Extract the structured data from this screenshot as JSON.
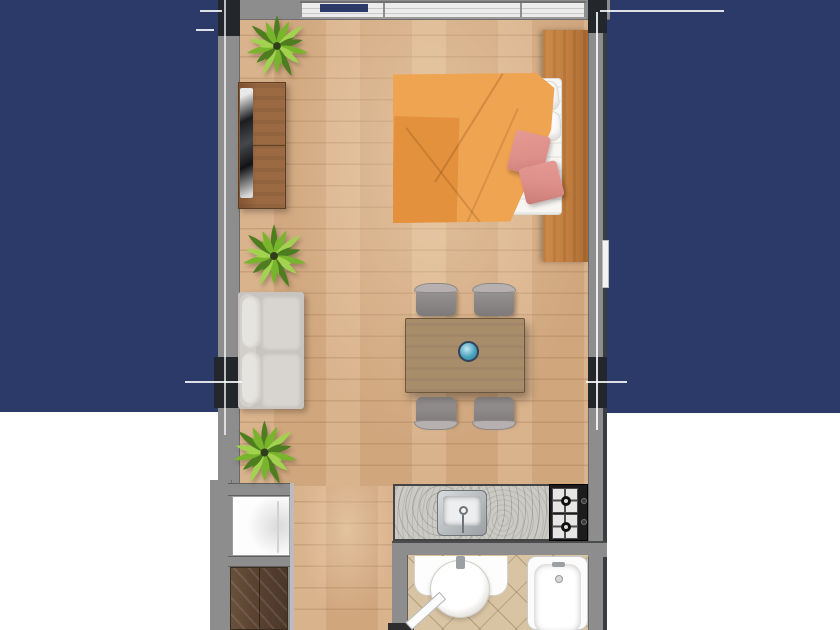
{
  "scene": {
    "type": "floor-plan",
    "title": "Studio apartment floor plan (top-down render)",
    "rooms": [
      "living-sleeping area",
      "kitchenette",
      "bathroom",
      "storage nook"
    ],
    "furniture": [
      "double-bed",
      "headboard",
      "pillows",
      "pink-throw-cushions",
      "tv-console",
      "television",
      "sofa",
      "potted-plant",
      "potted-plant",
      "potted-plant",
      "dining-table",
      "dining-chairs-x4",
      "decor-bowl",
      "kitchen-counter",
      "kitchen-sink",
      "gas-stove",
      "washing-machine",
      "wardrobe",
      "bathroom-vanity",
      "wash-basin",
      "bathtub",
      "bathroom-door"
    ]
  },
  "colors": {
    "navy": "#2b3a68",
    "wall": "#8d8d8d",
    "wall-dark": "#23262b",
    "wall-edge": "#3a3d42",
    "floor": "#d7ae85",
    "wood-cabinet": "#9b6a42",
    "wardrobe": "#5a4130",
    "headboard": "#c07d3e",
    "duvet": "#efa452",
    "duvet-dark": "#e3913c",
    "cushion-pink": "#dd8e89",
    "sofa": "#d9d7d3",
    "table": "#a88d6b",
    "chair": "#908b8b",
    "bowl-teal": "#4aa3bd",
    "granite": "#cbcac4",
    "stove": "#1c1c1c",
    "tile": "#d8c3a2",
    "plant-dark": "#4d7d1f",
    "plant-mid": "#79b42d",
    "plant-light": "#a2d24f",
    "dimension-line": "#ffffff"
  }
}
